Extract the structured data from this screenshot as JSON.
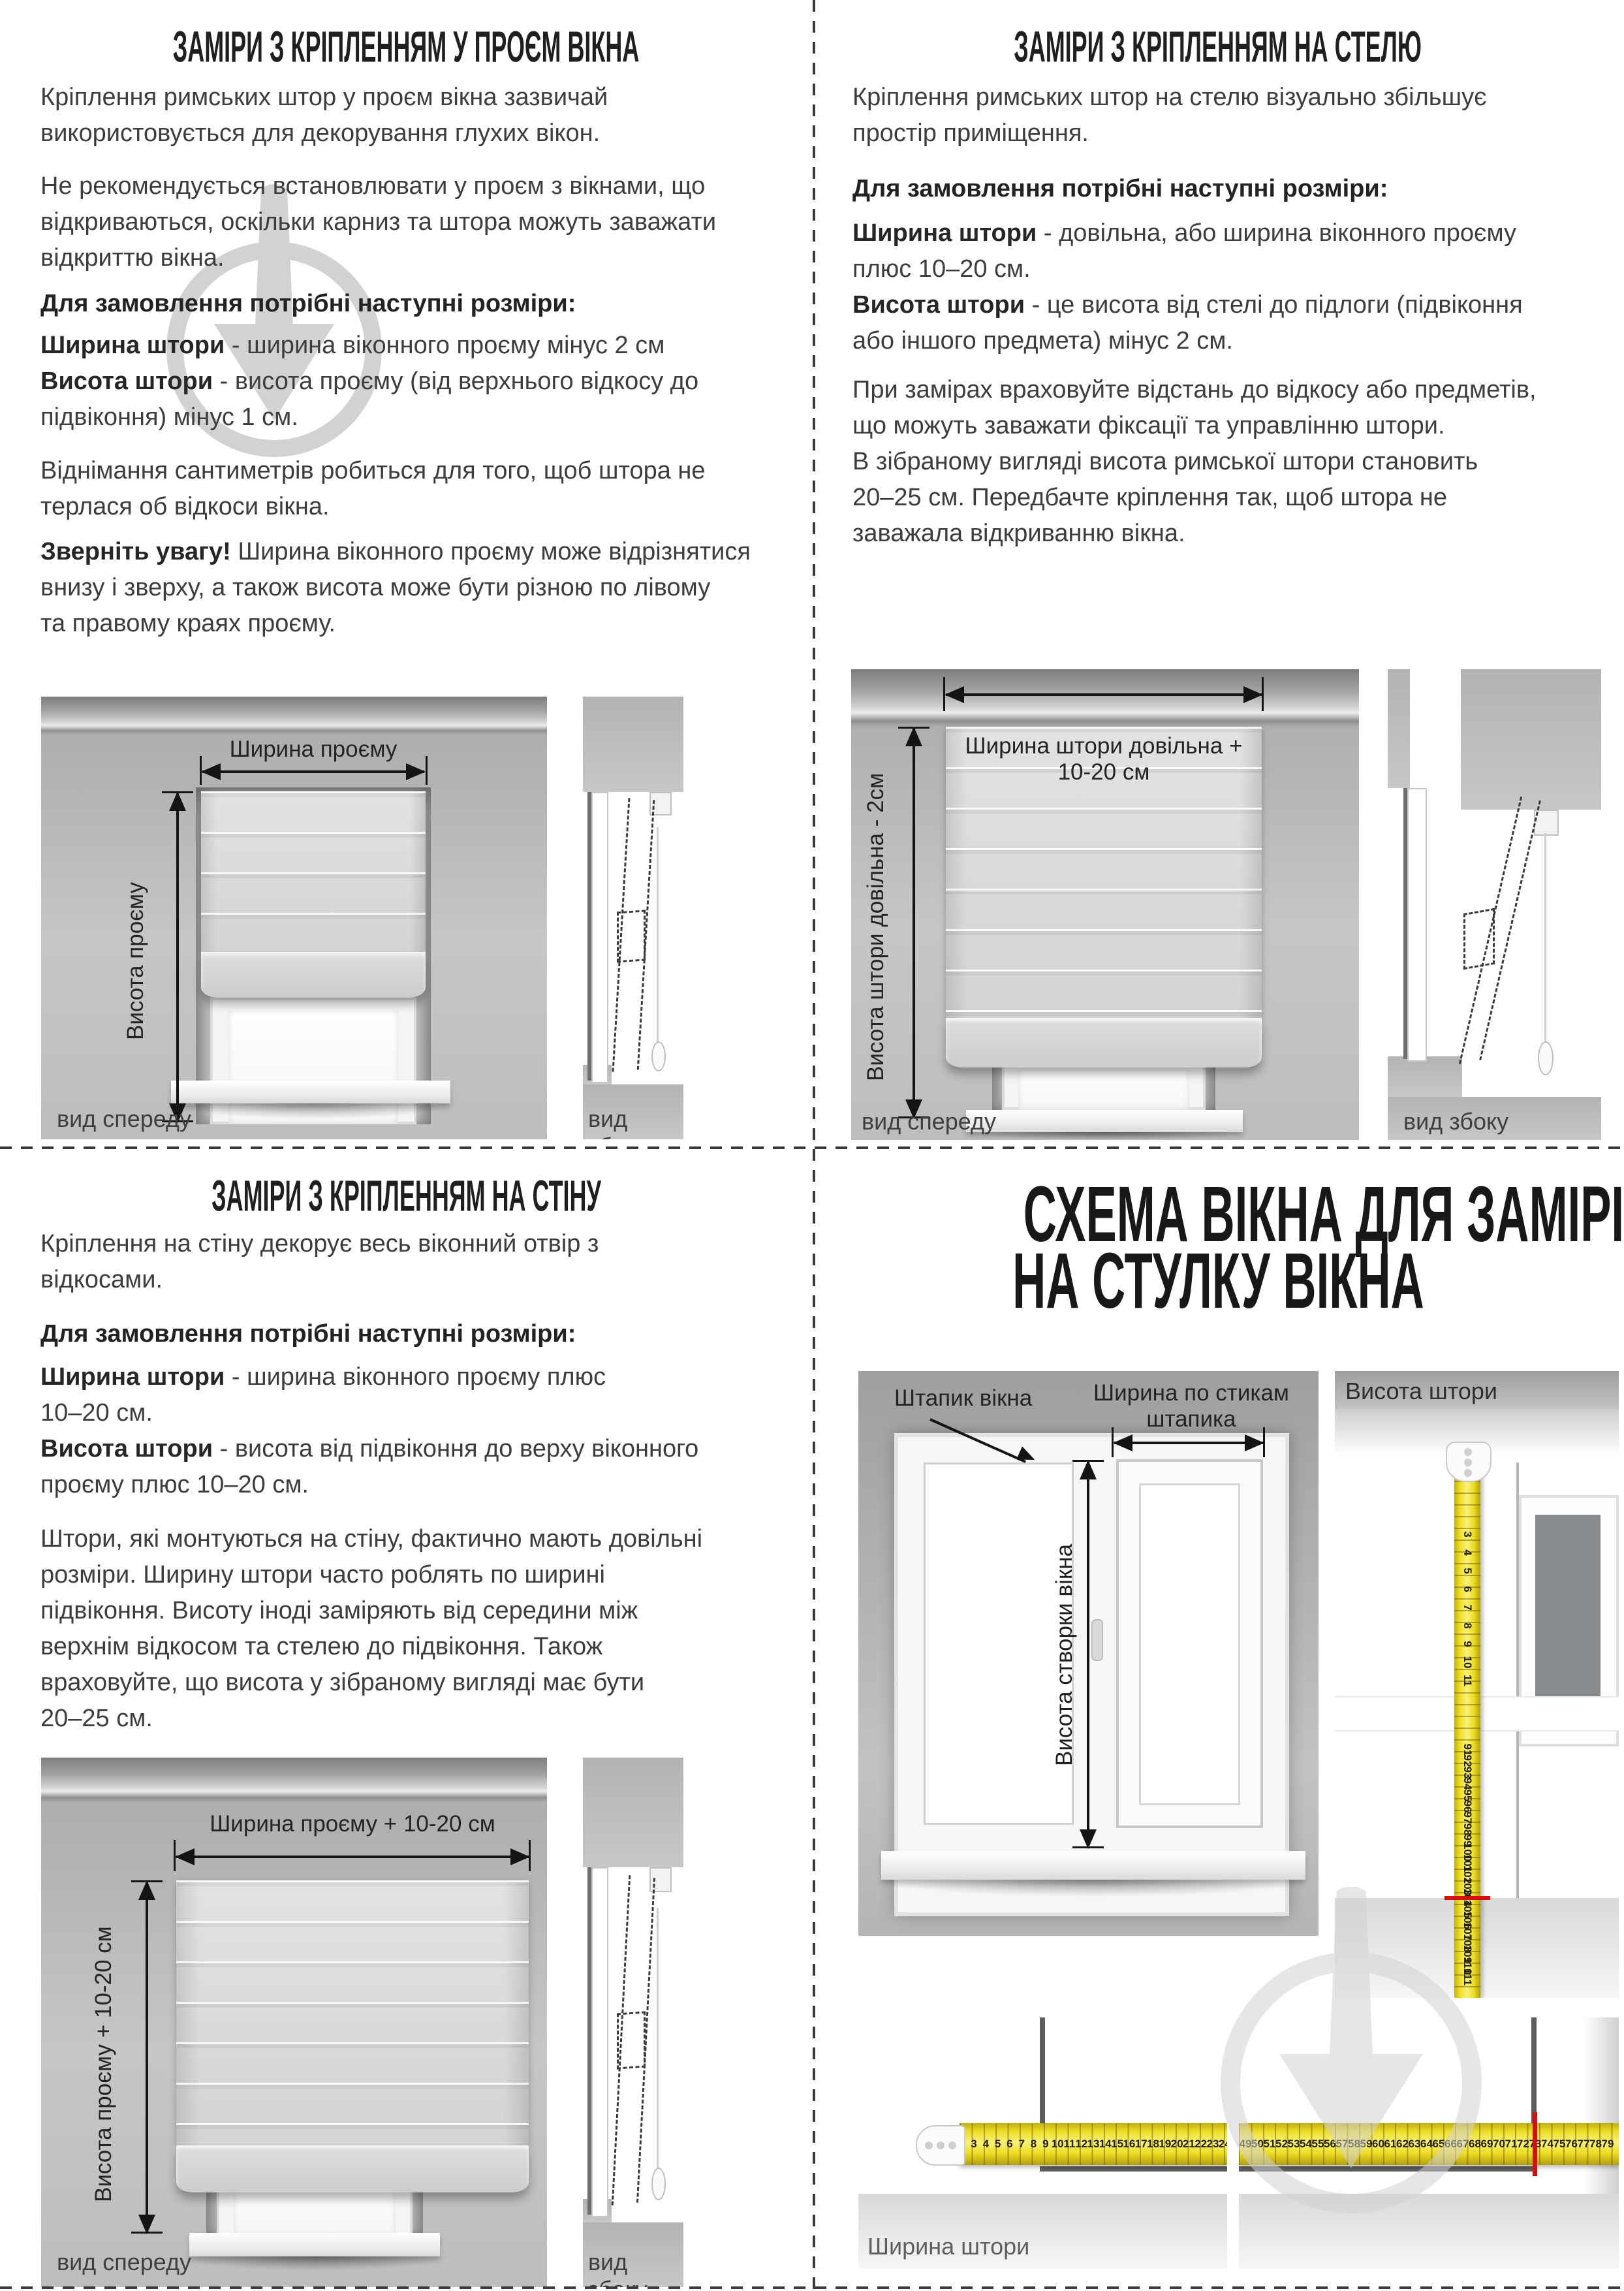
{
  "colors": {
    "tape_yellow": "#eedf28",
    "mark_red": "#d30f0f",
    "watermark_gray": "#d2d2d2",
    "body_text": "#3d3d3d",
    "title_text": "#1f1f1f"
  },
  "q1": {
    "title": "ЗАМІРИ З КРІПЛЕННЯМ У ПРОЄМ ВІКНА",
    "p1": "Кріплення римських штор у проєм вікна зазвичай\nвикористовується для декорування глухих вікон.",
    "p2": "Не рекомендується встановлювати у проєм з вікнами, що\nвідкриваються, оскільки карниз та штора можуть заважати\nвідкриттю вікна.",
    "order_heading": "Для замовлення потрібні наступні розміри:",
    "spec_width_term": "Ширина штори",
    "spec_width_desc": " - ширина віконного проєму мінус 2 см",
    "spec_height_term": "Висота штори",
    "spec_height_desc": " - висота проєму (від верхнього відкосу до\nпідвіконня) мінус 1 см.",
    "p5": "Віднімання сантиметрів робиться для того, щоб штора не\nтерлася об відкоси вікна.",
    "note_term": "Зверніть увагу!",
    "note_desc": " Ширина віконного проєму може відрізнятися\nвнизу і зверху, а також висота може бути різною по лівому\nта правому краях проєму.",
    "width_label": "Ширина проєму",
    "height_label": "Висота проєму",
    "front_view": "вид спереду",
    "side_view": "вид збоку"
  },
  "q2": {
    "title": "ЗАМІРИ З КРІПЛЕННЯМ НА СТЕЛЮ",
    "p1": "Кріплення римських штор на стелю візуально збільшує\nпростір приміщення.",
    "order_heading": "Для замовлення потрібні наступні розміри:",
    "spec_width_term": "Ширина штори",
    "spec_width_desc": " - довільна, або ширина віконного проєму\nплюс 10–20 см.",
    "spec_height_term": "Висота штори",
    "spec_height_desc": " - це висота від стелі до підлоги (підвіконня\nабо іншого предмета) мінус 2 см.",
    "p4": "При замірах враховуйте відстань до відкосу або предметів,\nщо можуть заважати фіксації та управлінню штори.\nВ зібраному вигляді висота римської штори становить\n20–25 см. Передбачте кріплення так, щоб штора не\nзаважала відкриванню вікна.",
    "width_label": "Ширина штори довільна + 10-20 см",
    "height_label": "Висота штори довільна - 2см",
    "front_view": "вид спереду",
    "side_view": "вид збоку"
  },
  "q3": {
    "title": "ЗАМІРИ З КРІПЛЕННЯМ НА СТІНУ",
    "p1": "Кріплення на стіну декорує весь віконний отвір з\nвідкосами.",
    "order_heading": "Для замовлення потрібні наступні розміри:",
    "spec_width_term": "Ширина штори",
    "spec_width_desc": " - ширина віконного проєму плюс\n10–20 см.",
    "spec_height_term": "Висота штори",
    "spec_height_desc": " - висота від підвіконня до верху віконного\nпроєму плюс 10–20 см.",
    "p4": "Штори, які монтуються на стіну, фактично мають довільні\nрозміри. Ширину штори часто роблять по ширині\nпідвіконня. Висоту іноді заміряють від середини між\nверхнім відкосом та стелею до підвіконня. Також\nвраховуйте, що висота у зібраному вигляді має бути\n20–25 см.",
    "width_label": "Ширина проєму + 10-20 см",
    "height_label": "Висота проєму + 10-20 см",
    "front_view": "вид спереду",
    "side_view": "вид збоку"
  },
  "q4": {
    "title_line1": "СХЕМА ВІКНА ДЛЯ ЗАМІРІВ",
    "title_line2": "НА СТУЛКУ ВІКНА",
    "bead_label": "Штапик вікна",
    "bead_width_label": "Ширина по стикам\nштапика",
    "sash_height_label": "Висота створки вікна",
    "curtain_height_label": "Висота штори",
    "curtain_width_label": "Ширина штори",
    "vtape_top": [
      3,
      4,
      5,
      6,
      7,
      8,
      9,
      10,
      11
    ],
    "vtape_bottom": [
      91,
      92,
      93,
      94,
      95,
      96,
      97,
      98,
      99,
      100,
      101,
      102,
      103,
      104,
      105,
      106,
      107,
      108,
      109,
      110,
      111
    ],
    "vtape_red_mark": 104,
    "htape_left": [
      3,
      4,
      5,
      6,
      7,
      8,
      9,
      10,
      11,
      12,
      13,
      14,
      15,
      16,
      17,
      18,
      19,
      20,
      21,
      22,
      23,
      24
    ],
    "htape_right": [
      49,
      50,
      51,
      52,
      53,
      54,
      55,
      56,
      57,
      58,
      59,
      60,
      61,
      62,
      63,
      64,
      65,
      66,
      67,
      68,
      69,
      70,
      71,
      72,
      73,
      74,
      75,
      76,
      77,
      78,
      79
    ],
    "htape_red_mark": 73
  }
}
